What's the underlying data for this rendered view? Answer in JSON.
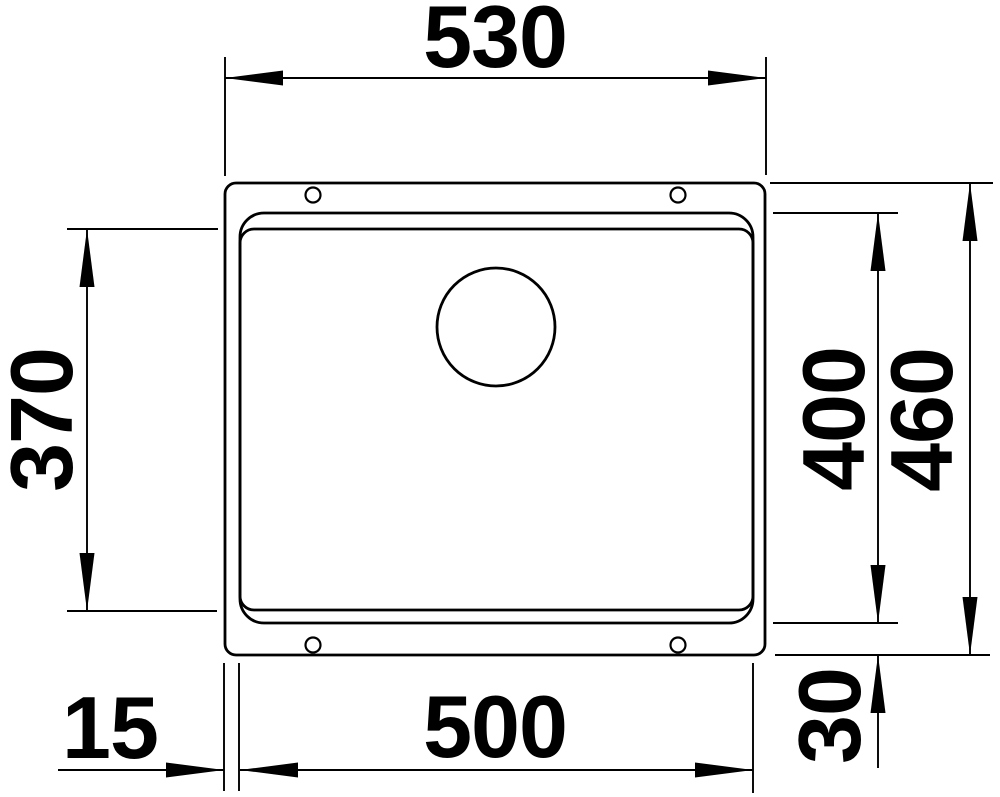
{
  "drawing": {
    "kind": "technical-dimension-drawing",
    "subject": "undermount-sink-top-view",
    "colors": {
      "line": "#000000",
      "background": "#ffffff"
    },
    "dimensions": {
      "outer_width": "530",
      "bowl_inner_height": "370",
      "bowl_height": "400",
      "outer_height": "460",
      "bowl_width": "500",
      "side_offset": "15",
      "bottom_offset": "30"
    }
  }
}
